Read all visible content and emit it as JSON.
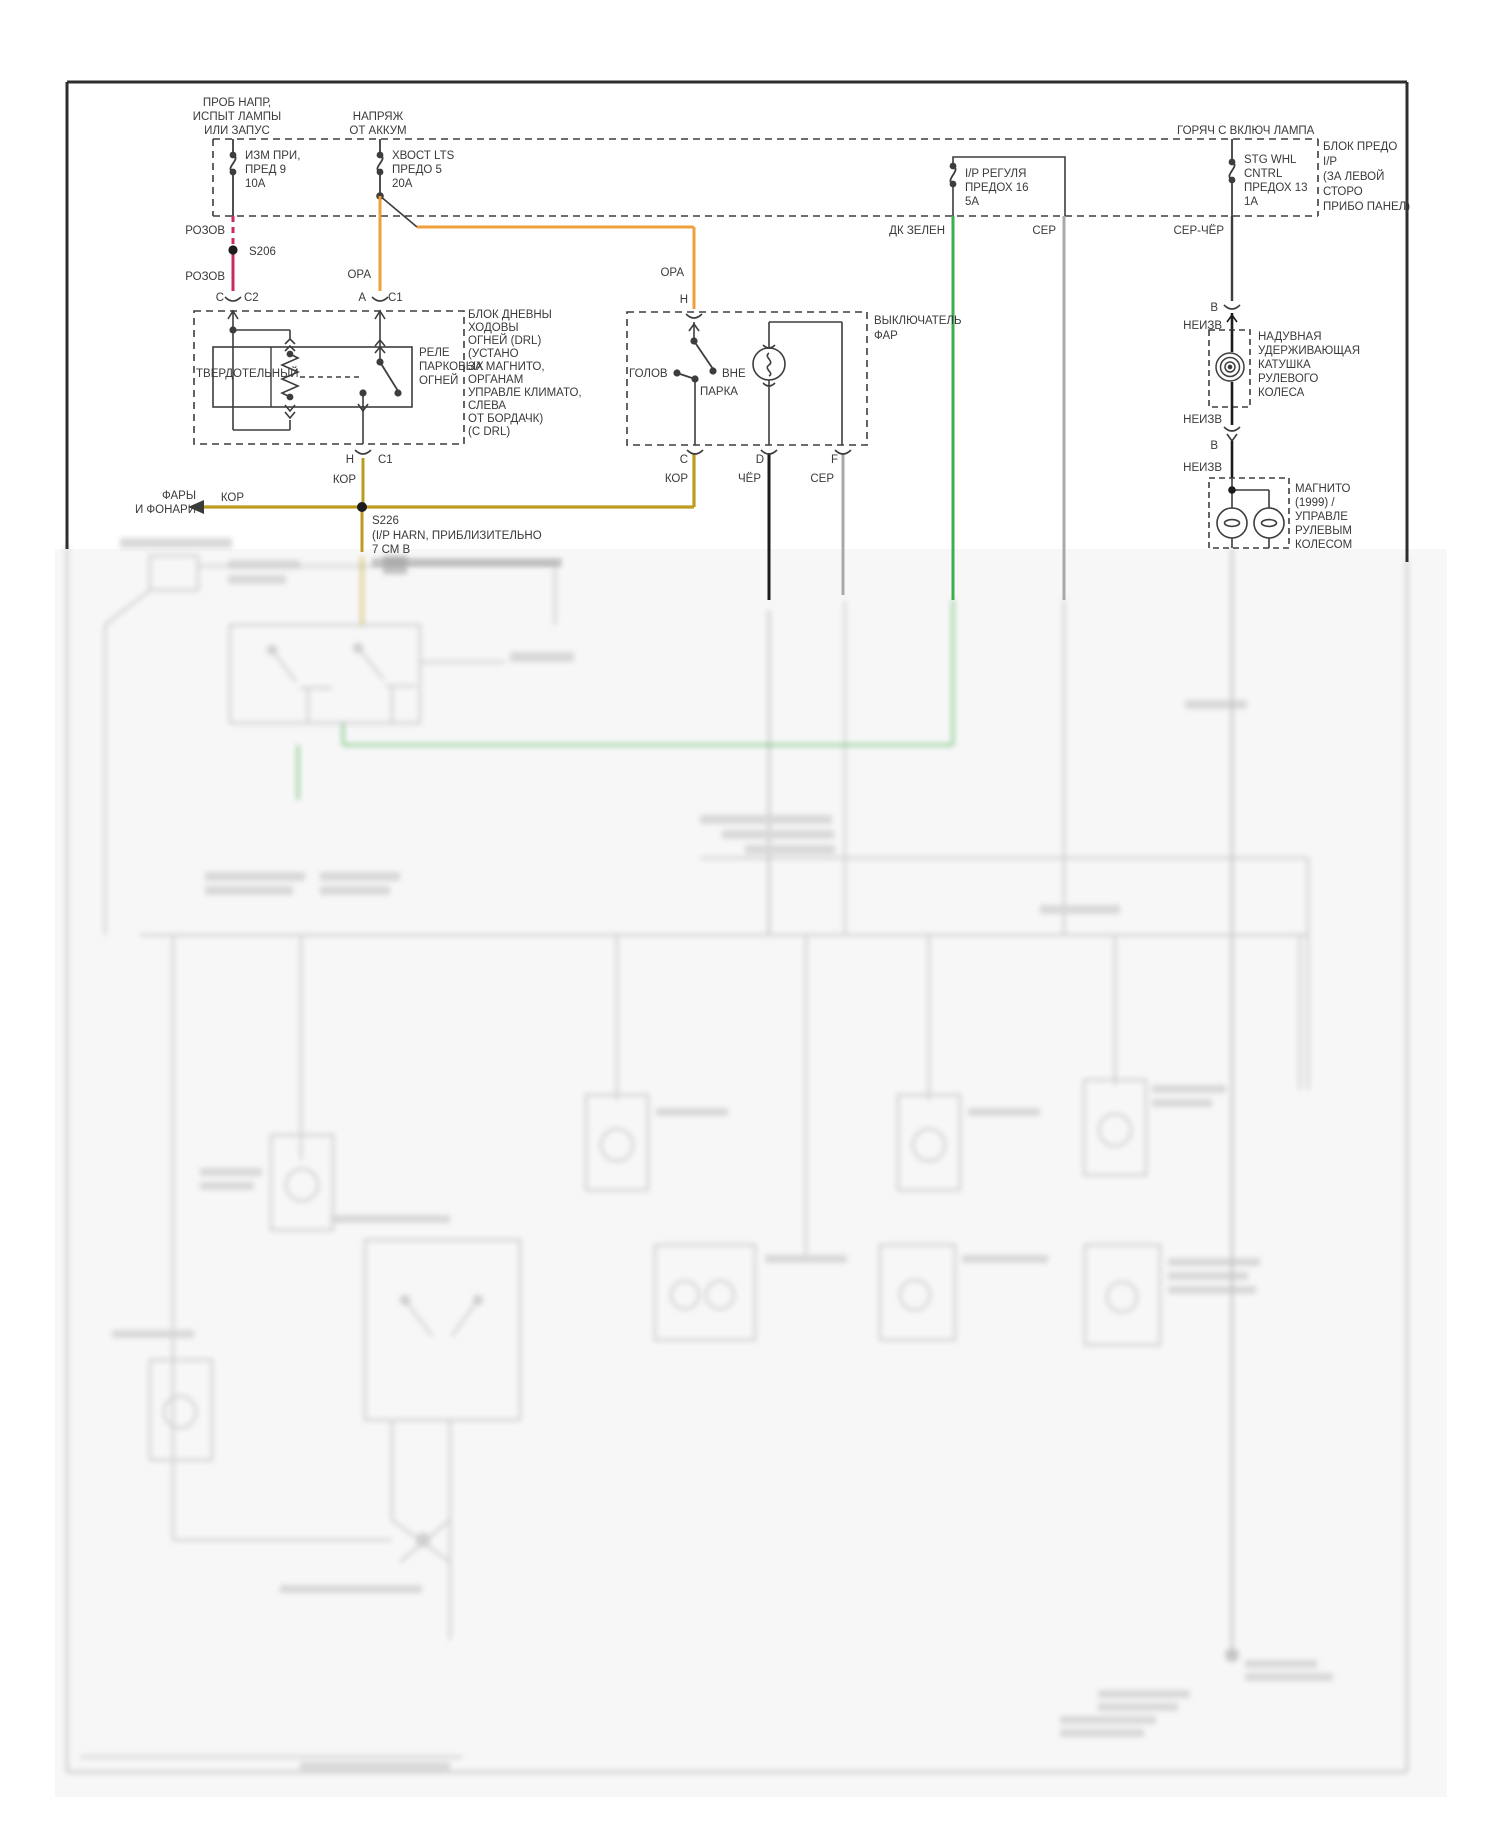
{
  "rails": {
    "left_feed": [
      "ПРОБ НАПР,",
      "ИСПЫТ ЛАМПЫ",
      "ИЛИ ЗАПУС"
    ],
    "battery_feed": [
      "НАПРЯЖ",
      "ОТ АККУМ"
    ],
    "hot_in_run": "ГОРЯЧ С ВКЛЮЧ ЛАМПА"
  },
  "fuse_block_caption": [
    "БЛОК ПРЕДО",
    "I/P",
    "(ЗА ЛЕВОЙ",
    "СТОРО",
    "ПРИБО ПАНЕЛ)"
  ],
  "fuses": [
    {
      "lines": [
        "ИЗМ ПРИ,",
        "ПРЕД 9",
        "10А"
      ]
    },
    {
      "lines": [
        "ХВОСТ LTS",
        "ПРЕДО 5",
        "20А"
      ]
    },
    {
      "lines": [
        "I/P РЕГУЛЯ",
        "ПРЕДОХ 16",
        "5А"
      ]
    },
    {
      "lines": [
        "STG WHL",
        "CNTRL",
        "ПРЕДОХ 13",
        "1А"
      ]
    }
  ],
  "wire_labels": {
    "pink_upper": "РОЗОВ",
    "pink_lower": "РОЗОВ",
    "orange_a": "ОРА",
    "orange_h": "ОРА",
    "dk_green": "ДК ЗЕЛЕН",
    "gray_bus": "СЕР",
    "gray_black": "СЕР-ЧЁР",
    "brown_h": "КОР",
    "brown_arrow": "КОР",
    "brown_c": "КОР",
    "black_d": "ЧЁР",
    "gray_f": "СЕР"
  },
  "splices": {
    "s206": "S206",
    "s226": "S226",
    "s226_lines": [
      "(I/P HARN, ПРИБЛИЗИТЕЛЬНО",
      "7 СМ В"
    ]
  },
  "pins": {
    "c": "C",
    "c2": "C2",
    "a": "A",
    "c1": "C1",
    "h_bottom": "H",
    "c1_bottom": "C1",
    "h_switch": "H",
    "c_switch": "C",
    "d_switch": "D",
    "f_switch": "F",
    "b_top": "В",
    "unk_top": "НЕИЗВ",
    "unk_mid": "НЕИЗВ",
    "b_mid": "В",
    "unk_low": "НЕИЗВ"
  },
  "drl_block": {
    "solid_state": "ТВЕРДОТЕЛЬНЫЙ",
    "relay": [
      "РЕЛЕ",
      "ПАРКОВЫХ",
      "ОГНЕЙ"
    ],
    "caption": [
      "БЛОК ДНЕВНЫ",
      "ХОДОВЫ",
      "ОГНЕЙ (DRL)",
      "(УСТАНО",
      "ЗА МАГНИТО,",
      "ОРГАНАМ",
      "УПРАВЛЕ КЛИМАТО,",
      "СЛЕВА",
      "ОТ БОРДАЧК)",
      "(С DRL)"
    ]
  },
  "headlamp_switch": {
    "caption": [
      "ВЫКЛЮЧАТЕЛЬ",
      "ФАР"
    ],
    "head": "ГОЛОВ",
    "off": "ВНЕ",
    "park": "ПАРКА"
  },
  "clockspring_caption": [
    "НАДУВНАЯ",
    "УДЕРЖИВАЮЩАЯ",
    "КАТУШКА",
    "РУЛЕВОГО",
    "КОЛЕСА"
  ],
  "radio_caption": [
    "МАГНИТО",
    "(1999)   /",
    "УПРАВЛЕ",
    "РУЛЕВЫМ",
    "КОЛЕСОМ"
  ],
  "arrow_out": [
    "ФАРЫ",
    "И ФОНАРИ"
  ],
  "colors": {
    "pink": "#cb2a5e",
    "orange": "#efa03c",
    "brown": "#bd9b1e",
    "green": "#3fae4c",
    "gray_wire": "#a9a9a9",
    "black_wire": "#1c1c1c",
    "line": "#3d3d3d"
  }
}
